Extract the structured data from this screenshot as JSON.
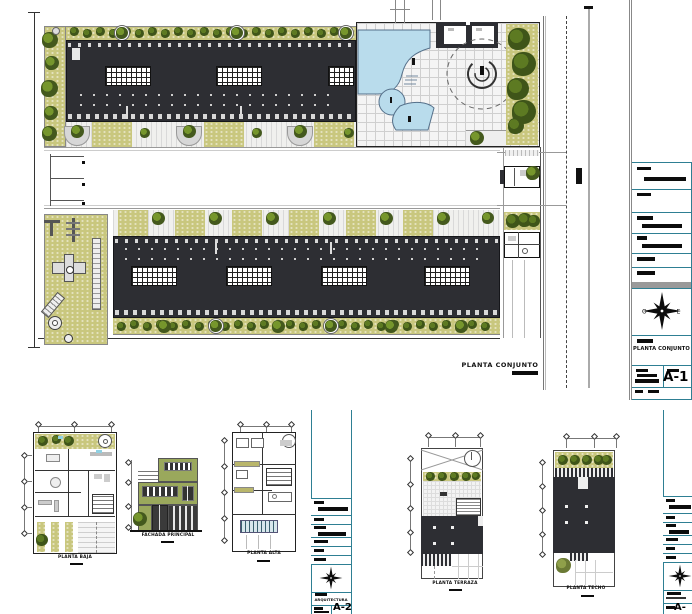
{
  "sheets": {
    "a1": {
      "plan_label": "PLANTA CONJUNTO",
      "title_block": {
        "drawing_title": "PLANTA CONJUNTO",
        "sheet_number": "A-1",
        "compass_west": "O",
        "compass_east": "E"
      }
    },
    "a2": {
      "drawings": [
        {
          "label": "PLANTA BAJA"
        },
        {
          "label": "FACHADA PRINCIPAL"
        },
        {
          "label": "PLANTA ALTA"
        }
      ],
      "title_block": {
        "discipline_label": "ARQUITECTURA",
        "sheet_number": "A-2"
      }
    },
    "a3": {
      "drawings": [
        {
          "label": "PLANTA TERRAZA"
        },
        {
          "label": "PLANTA TECHO"
        }
      ],
      "title_block": {
        "sheet_number": "A-"
      }
    }
  },
  "colors": {
    "roof_dark": "#2d2e33",
    "landscape_olive": "#c9c77e",
    "tree_green": "#44591d",
    "tree_light": "#76962c",
    "pool_blue": "#b9dcec",
    "titleblock_teal": "#2e7f93",
    "elevation_olive": "#9aa85c"
  }
}
